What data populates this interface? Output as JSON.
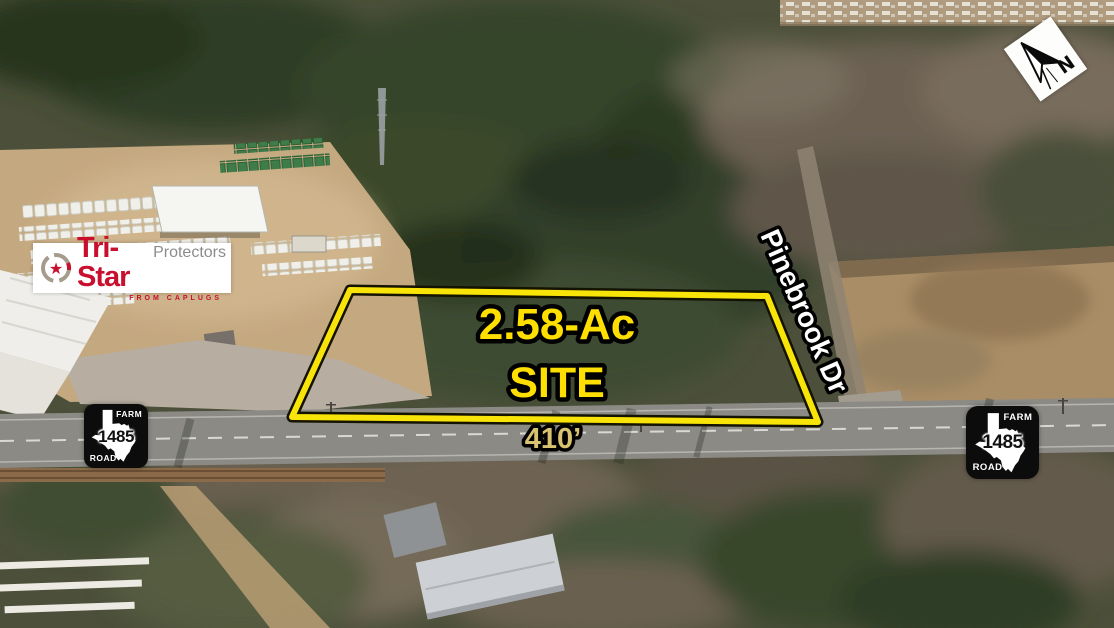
{
  "overlay": {
    "acreage": "2.58-Ac",
    "site": "SITE",
    "frontage": "410’",
    "street": "Pinebrook Dr"
  },
  "shield": {
    "farm": "FARM",
    "road": "ROAD",
    "number": "1485"
  },
  "logo": {
    "brand": "Tri-Star",
    "suffix": "Protectors",
    "tagline": "FROM CAPLUGS"
  },
  "compass": {
    "label": "N"
  },
  "icons": {
    "star": "★"
  },
  "colors": {
    "site_outline": "#f8e408",
    "site_text": "#ffdf00",
    "frontage_text": "#d9c270",
    "street_text": "#ffffff",
    "logo_red": "#c8102e",
    "logo_gray": "#8c8c8c",
    "shield_bg": "#0c0c0c"
  }
}
